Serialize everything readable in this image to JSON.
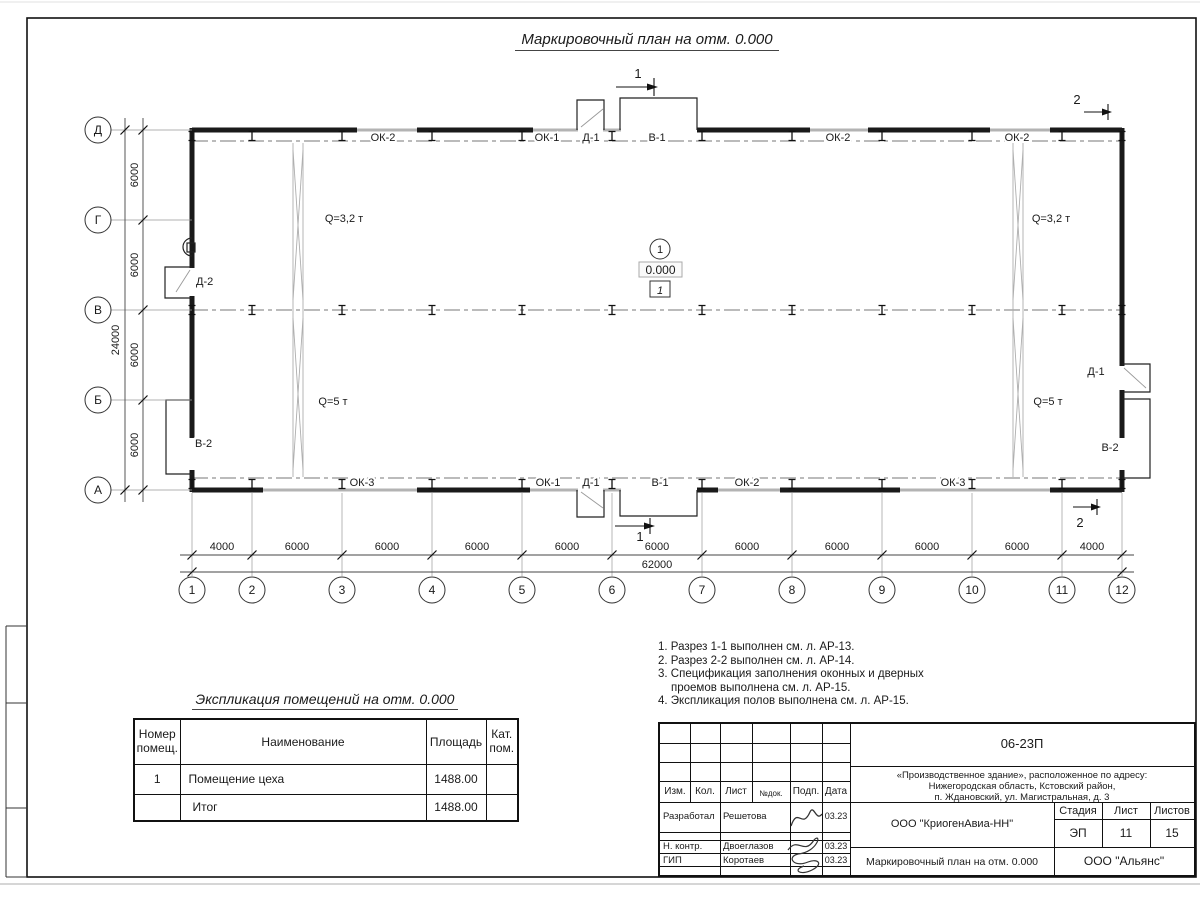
{
  "sheet": {
    "plan_title": "Маркировочный план на отм. 0.000"
  },
  "plan": {
    "col_axes": [
      "1",
      "2",
      "3",
      "4",
      "5",
      "6",
      "7",
      "8",
      "9",
      "10",
      "11",
      "12"
    ],
    "row_axes": [
      "Д",
      "Г",
      "В",
      "Б",
      "А"
    ],
    "dims_bottom": [
      "4000",
      "6000",
      "6000",
      "6000",
      "6000",
      "6000",
      "6000",
      "6000",
      "6000",
      "6000",
      "4000"
    ],
    "dim_total_bottom": "62000",
    "dims_left": [
      "6000",
      "6000",
      "6000",
      "6000"
    ],
    "dim_total_left": "24000",
    "top_wall_labels": [
      "ОК-2",
      "ОК-1",
      "Д-1",
      "В-1",
      "ОК-2",
      "ОК-2"
    ],
    "bottom_wall_labels": [
      "ОК-3",
      "ОК-1",
      "Д-1",
      "В-1",
      "ОК-2",
      "ОК-3"
    ],
    "opening_labels": [
      "Д-2",
      "В-2",
      "Д-1",
      "В-2"
    ],
    "crane_labels": [
      "Q=3,2 т",
      "Q=3,2 т",
      "Q=5 т",
      "Q=5 т"
    ],
    "section_1": "1",
    "section_2": "2",
    "level_mark": {
      "axis_no": "1",
      "elevation": "0.000",
      "room_no": "1"
    }
  },
  "explication": {
    "title": "Экспликация помещений на отм. 0.000",
    "headers": [
      "Номер помещ.",
      "Наименование",
      "Площадь",
      "Кат. пом."
    ],
    "rows": [
      {
        "num": "1",
        "name": "Помещение цеха",
        "area": "1488.00",
        "cat": ""
      },
      {
        "num": "",
        "name": "Итог",
        "area": "1488.00",
        "cat": ""
      }
    ]
  },
  "notes": {
    "line1": "1. Разрез 1-1 выполнен см. л. АР-13.",
    "line2": "2. Разрез 2-2 выполнен см. л. АР-14.",
    "line3": "3. Спецификация заполнения оконных и дверных",
    "line4": "проемов выполнена см. л. АР-15.",
    "line5": "4. Экспликация полов выполнена см. л. АР-15."
  },
  "titleblock": {
    "doc_number": "06-23П",
    "address_line1": "«Производственное здание», расположенное по адресу:",
    "address_line2": "Нижегородская область, Кстовский район,",
    "address_line3": "п. Ждановский, ул. Магистральная, д. 3",
    "col_izm": "Изм.",
    "col_kol": "Кол.",
    "col_list": "Лист",
    "col_doc": "№док.",
    "col_podp": "Подп.",
    "col_data": "Дата",
    "role1": "Разработал",
    "name1": "Решетова",
    "date1": "03.23",
    "role2": "Н. контр.",
    "name2": "Двоеглазов",
    "date2": "03.23",
    "role3": "ГИП",
    "name3": "Коротаев",
    "date3": "03.23",
    "company": "ООО \"КриогенАвиа-НН\"",
    "stage_label": "Стадия",
    "sheet_label": "Лист",
    "sheets_label": "Листов",
    "stage": "ЭП",
    "sheet": "11",
    "sheets": "15",
    "drawing_title": "Маркировочный план на отм. 0.000",
    "contractor": "ООО \"Альянс\""
  }
}
